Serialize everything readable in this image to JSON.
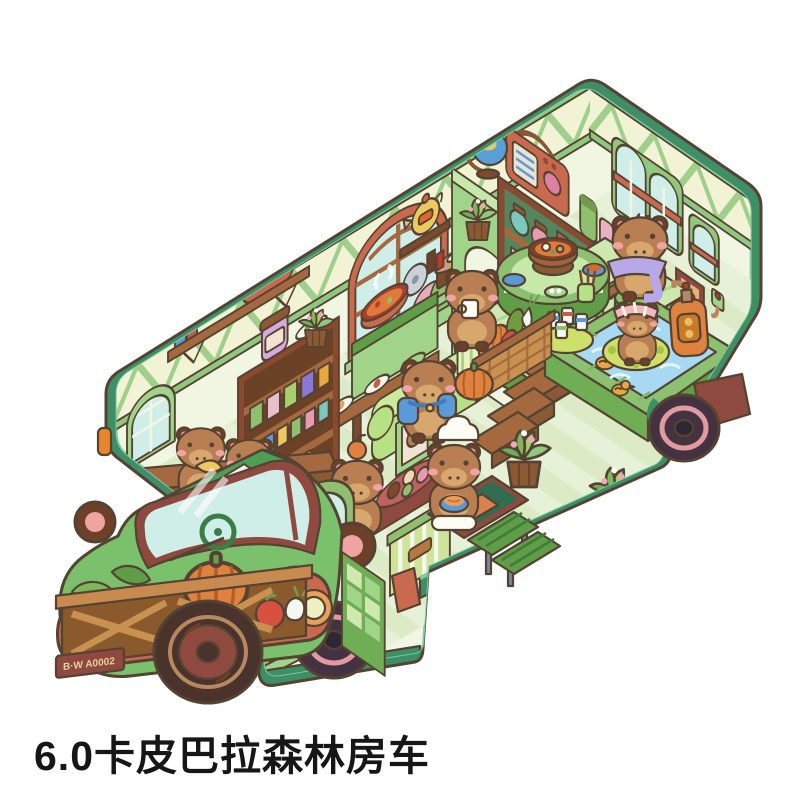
{
  "caption": {
    "text": "6.0卡皮巴拉森林房车"
  },
  "vehicle": {
    "license_plate": "B·W A0002",
    "description": "isometric cutaway illustration of a green capybara forest camper truck",
    "rooms": [
      "pantry shelves",
      "kitchen",
      "dining area",
      "bath pool",
      "lounge couch",
      "entry step"
    ],
    "capybaras": [
      {
        "accessory": "banana",
        "location": "loft above cab"
      },
      {
        "accessory": "green scarf",
        "location": "loft ledge"
      },
      {
        "accessory": "blue backpack",
        "location": "lounge couch"
      },
      {
        "accessory": "orange on head",
        "location": "lower floor"
      },
      {
        "accessory": "chef hat and noodle bowl",
        "location": "entry"
      },
      {
        "accessory": "white cup",
        "location": "dining table"
      },
      {
        "accessory": "purple towel",
        "location": "dining stool"
      },
      {
        "accessory": "striped headband and swim ring",
        "location": "bath pool"
      }
    ],
    "props": [
      "radio",
      "globe",
      "bookshelf jars",
      "toaster shelf",
      "teapot shelf",
      "plate rack",
      "hotpot table",
      "fruit basket",
      "pumpkin crate",
      "rubber ducks",
      "soap pump bottle",
      "picnic step bench",
      "doormat",
      "potted plants",
      "picture frames",
      "staircase",
      "railing"
    ]
  },
  "palette": {
    "outline": "#544233",
    "bodyGreen": "#3e8e67",
    "bodyEdge": "#7ecba2",
    "wallCream": "#f1f6e3",
    "trussFill": "#f2f3d4",
    "trussGreen": "#8fc87e",
    "floorGreen": "#e7f1d8",
    "floorStripe": "#dcebc6",
    "partGreen": "#9fd489",
    "partLight": "#c6e8a8",
    "platGreen": "#8cc172",
    "platDark": "#5f9e46",
    "tileLight": "#cfe8b0",
    "water": "#a8d9f2",
    "wood": "#a5693f",
    "woodDark": "#7c4a2c",
    "woodDeep": "#8a5a35",
    "maroon": "#8e4a3e",
    "terra": "#c96a4e",
    "capy": "#b97f52",
    "capyLight": "#d8a76d",
    "capyDark": "#6e4028",
    "cheek": "#f0a3a3",
    "lime": "#b8e084",
    "limeLight": "#cdea9a",
    "glass": "#cfeee8",
    "orange": "#e0823f",
    "yellow": "#ecc95f",
    "cream2": "#eef0c0",
    "tire": "#4a332c",
    "tire2": "#453240",
    "ringPink": "#e09aa0",
    "cabGreen": "#7bc06b",
    "cabDark": "#4f9e55"
  }
}
